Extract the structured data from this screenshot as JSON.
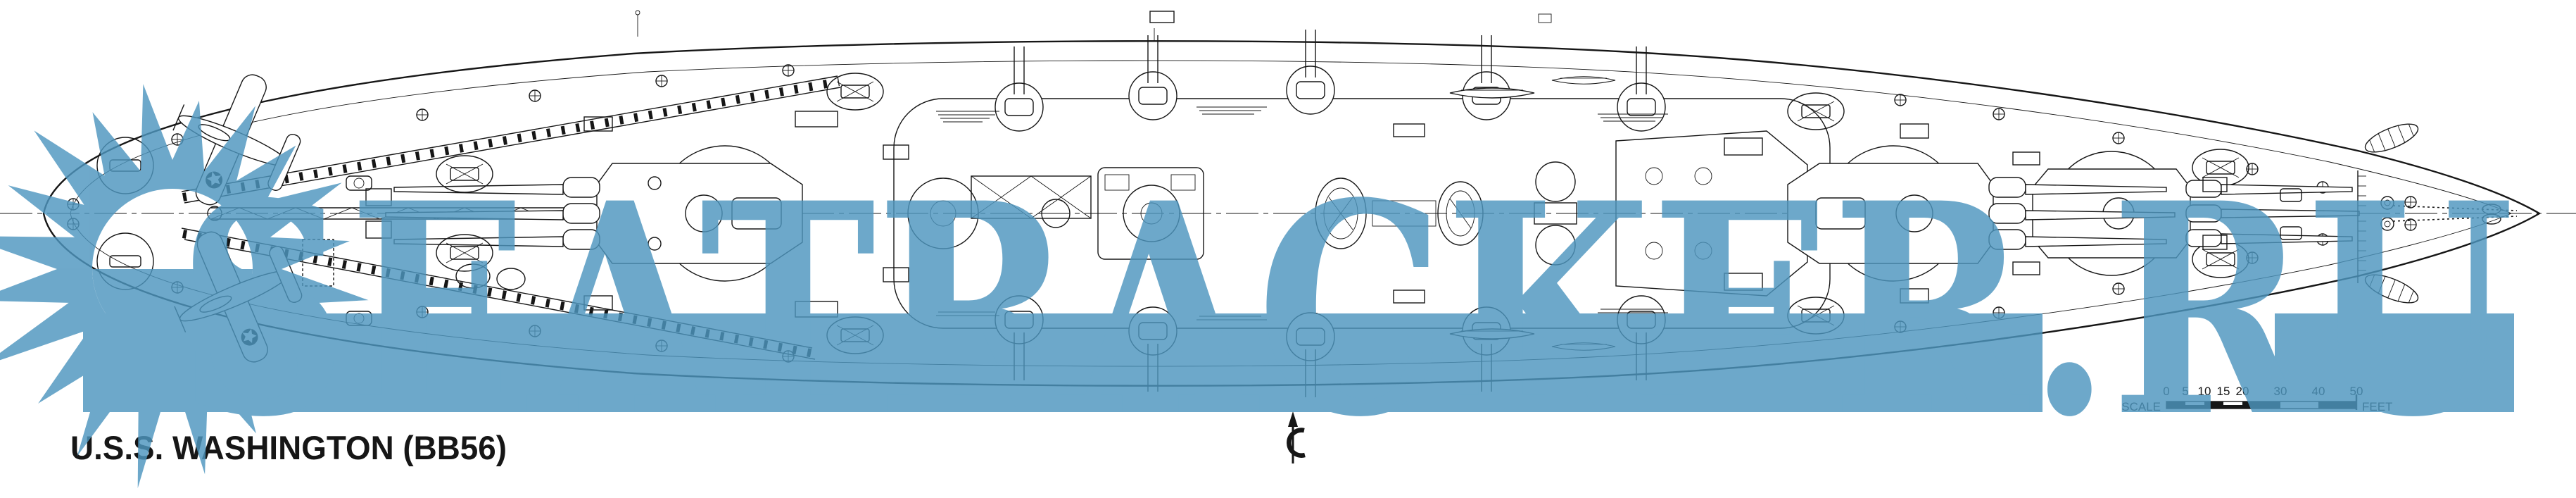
{
  "title": "U.S.S. WASHINGTON (BB56)",
  "watermark": {
    "text": "SEATRACKER.RU",
    "color": "#4E96BF",
    "opacity": "0.82"
  },
  "logo": {
    "shape": "sunburst-star-with-half-disc",
    "points": 20,
    "color": "#4E96BF"
  },
  "centerline_symbol": "℄",
  "scale_bar": {
    "label": "SCALE",
    "unit": "FEET",
    "ticks": [
      "0",
      "5",
      "10",
      "15",
      "20",
      "30",
      "40",
      "50"
    ]
  },
  "colors": {
    "ink": "#161616",
    "paper": "#ffffff",
    "watermark_blue": "#4E96BF"
  }
}
